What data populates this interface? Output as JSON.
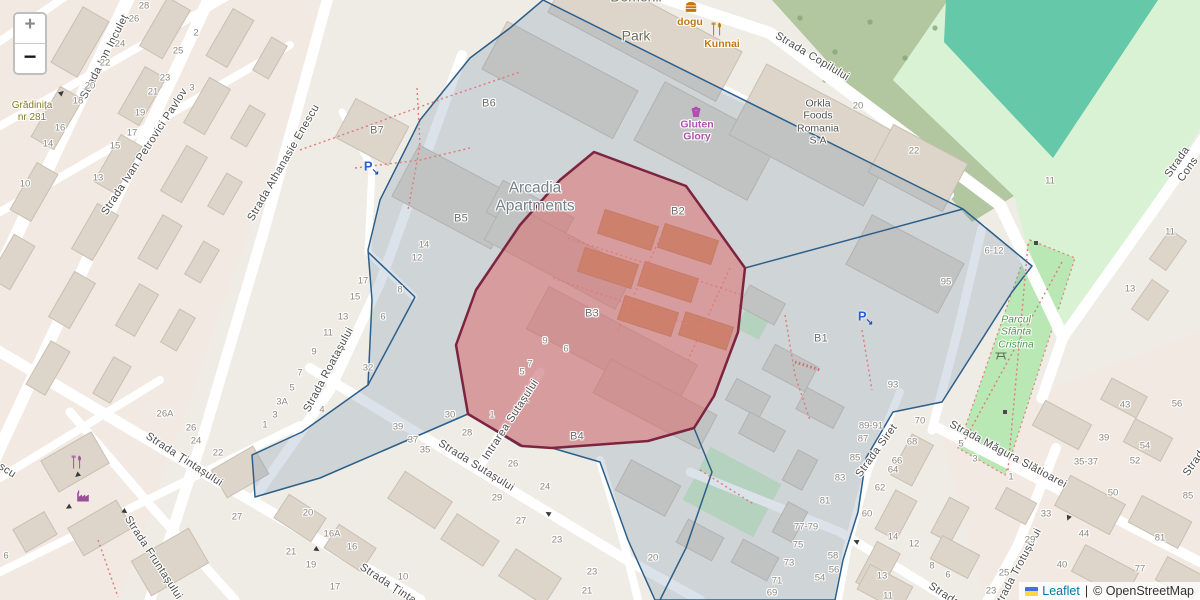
{
  "controls": {
    "zoom_in_label": "+",
    "zoom_out_label": "−"
  },
  "attribution": {
    "flag_icon": "ukraine-flag-icon",
    "leaflet_link": "Leaflet",
    "separator": "|",
    "osm_text": "© OpenStreetMap"
  },
  "colors": {
    "selection_red_fill": "#e05c5c",
    "selection_red_stroke": "#7d2440",
    "boundary_blue_stroke": "#2c5f8a",
    "boundary_blue_fill": "rgba(110,140,170,0.25)",
    "park_green": "#b9e8b4",
    "pitch_teal": "#56c3a4",
    "wood_green": "#a7bf93",
    "road_white": "#ffffff"
  },
  "map_labels": [
    {
      "text": "Strada Ion Inculeț",
      "x": 105,
      "y": 57,
      "rot": -63,
      "cls": "street"
    },
    {
      "text": "Strada Ivan Petrovici Pavlov",
      "x": 145,
      "y": 152,
      "rot": -57,
      "cls": "street"
    },
    {
      "text": "Strada Athanasie Enescu",
      "x": 284,
      "y": 163,
      "rot": -60,
      "cls": "street"
    },
    {
      "text": "Strada Copilului",
      "x": 812,
      "y": 57,
      "rot": 31,
      "cls": "street"
    },
    {
      "text": "Strada Cons",
      "x": 1183,
      "y": 166,
      "rot": -55,
      "cls": "street"
    },
    {
      "text": "Strada Roatașului",
      "x": 329,
      "y": 370,
      "rot": -62,
      "cls": "street"
    },
    {
      "text": "Strada Țintașului",
      "x": 184,
      "y": 460,
      "rot": 33,
      "cls": "street"
    },
    {
      "text": "Strada Țintașului",
      "x": 398,
      "y": 591,
      "rot": 33,
      "cls": "street"
    },
    {
      "text": "Strada Fruntașului",
      "x": 153,
      "y": 558,
      "rot": 57,
      "cls": "street"
    },
    {
      "text": "Strada Sutașului",
      "x": 476,
      "y": 466,
      "rot": 32,
      "cls": "street"
    },
    {
      "text": "Intrarea Sutașului",
      "x": 511,
      "y": 420,
      "rot": -57,
      "cls": "street"
    },
    {
      "text": "Strada Siret",
      "x": 877,
      "y": 451,
      "rot": -54,
      "cls": "street"
    },
    {
      "text": "Strada Măgura Slătioarei",
      "x": 1008,
      "y": 455,
      "rot": 28,
      "cls": "street"
    },
    {
      "text": "Strada Trotușului",
      "x": 1018,
      "y": 569,
      "rot": -62,
      "cls": "street"
    },
    {
      "text": "Strada",
      "x": 1196,
      "y": 461,
      "rot": -55,
      "cls": "street"
    },
    {
      "text": "Strada",
      "x": 944,
      "y": 595,
      "rot": 33,
      "cls": "street"
    },
    {
      "text": "scu",
      "x": 7,
      "y": 471,
      "rot": 33,
      "cls": "street"
    },
    {
      "text": "Domenii",
      "x": 636,
      "y": -3,
      "rot": 0,
      "cls": "poi-park-name"
    },
    {
      "text": "Park",
      "x": 636,
      "y": 36,
      "rot": 0,
      "cls": "poi-park-name"
    },
    {
      "text": "dogu",
      "x": 690,
      "y": 22,
      "rot": 0,
      "cls": "poi-food"
    },
    {
      "text": "Kunnai",
      "x": 722,
      "y": 44,
      "rot": 0,
      "cls": "poi-food"
    },
    {
      "text": "Gluten\nGlory",
      "x": 697,
      "y": 131,
      "rot": 0,
      "cls": "poi-shop"
    },
    {
      "text": "Orkla\nFoods\nRomania\nS.A",
      "x": 818,
      "y": 122,
      "rot": 0,
      "cls": "poi-building"
    },
    {
      "text": "Arcadia\nApartments",
      "x": 535,
      "y": 198,
      "rot": 0,
      "cls": "poi-complex"
    },
    {
      "text": "Parcul\nSfânta\nCristina",
      "x": 1016,
      "y": 332,
      "rot": 0,
      "cls": "poi-park-green"
    },
    {
      "text": "Grădinița\nnr 281",
      "x": 32,
      "y": 112,
      "rot": 0,
      "cls": "poi-school"
    },
    {
      "text": "B7",
      "x": 377,
      "y": 131,
      "rot": 0,
      "cls": "block"
    },
    {
      "text": "B6",
      "x": 489,
      "y": 104,
      "rot": 0,
      "cls": "block"
    },
    {
      "text": "B5",
      "x": 461,
      "y": 219,
      "rot": 0,
      "cls": "block"
    },
    {
      "text": "B2",
      "x": 678,
      "y": 212,
      "rot": 0,
      "cls": "block"
    },
    {
      "text": "B3",
      "x": 592,
      "y": 314,
      "rot": 0,
      "cls": "block"
    },
    {
      "text": "B1",
      "x": 821,
      "y": 339,
      "rot": 0,
      "cls": "block"
    },
    {
      "text": "B4",
      "x": 577,
      "y": 437,
      "rot": 0,
      "cls": "block"
    },
    {
      "text": "28",
      "x": 144,
      "y": 6,
      "rot": 0,
      "cls": "hnum"
    },
    {
      "text": "26",
      "x": 134,
      "y": 19,
      "rot": 0,
      "cls": "hnum"
    },
    {
      "text": "24",
      "x": 120,
      "y": 44,
      "rot": 0,
      "cls": "hnum"
    },
    {
      "text": "22",
      "x": 105,
      "y": 63,
      "rot": 0,
      "cls": "hnum"
    },
    {
      "text": "20",
      "x": 90,
      "y": 86,
      "rot": 0,
      "cls": "hnum"
    },
    {
      "text": "18",
      "x": 78,
      "y": 101,
      "rot": 0,
      "cls": "hnum"
    },
    {
      "text": "16",
      "x": 60,
      "y": 128,
      "rot": 0,
      "cls": "hnum"
    },
    {
      "text": "14",
      "x": 48,
      "y": 144,
      "rot": 0,
      "cls": "hnum"
    },
    {
      "text": "13",
      "x": 98,
      "y": 178,
      "rot": 0,
      "cls": "hnum"
    },
    {
      "text": "10",
      "x": 25,
      "y": 184,
      "rot": 0,
      "cls": "hnum"
    },
    {
      "text": "25",
      "x": 178,
      "y": 51,
      "rot": 0,
      "cls": "hnum"
    },
    {
      "text": "23",
      "x": 165,
      "y": 78,
      "rot": 0,
      "cls": "hnum"
    },
    {
      "text": "21",
      "x": 153,
      "y": 92,
      "rot": 0,
      "cls": "hnum"
    },
    {
      "text": "19",
      "x": 140,
      "y": 113,
      "rot": 0,
      "cls": "hnum"
    },
    {
      "text": "17",
      "x": 132,
      "y": 133,
      "rot": 0,
      "cls": "hnum"
    },
    {
      "text": "15",
      "x": 115,
      "y": 146,
      "rot": 0,
      "cls": "hnum"
    },
    {
      "text": "2",
      "x": 196,
      "y": 33,
      "rot": 0,
      "cls": "hnum"
    },
    {
      "text": "3",
      "x": 192,
      "y": 88,
      "rot": 0,
      "cls": "hnum"
    },
    {
      "text": "20",
      "x": 858,
      "y": 106,
      "rot": 0,
      "cls": "hnum"
    },
    {
      "text": "22",
      "x": 914,
      "y": 151,
      "rot": 0,
      "cls": "hnum"
    },
    {
      "text": "11",
      "x": 1050,
      "y": 181,
      "rot": 0,
      "cls": "hnum"
    },
    {
      "text": "11",
      "x": 1170,
      "y": 232,
      "rot": 0,
      "cls": "hnum"
    },
    {
      "text": "13",
      "x": 1130,
      "y": 289,
      "rot": 0,
      "cls": "hnum"
    },
    {
      "text": "6-12",
      "x": 994,
      "y": 251,
      "rot": 0,
      "cls": "hnum"
    },
    {
      "text": "95",
      "x": 946,
      "y": 282,
      "rot": 0,
      "cls": "hnum"
    },
    {
      "text": "93",
      "x": 893,
      "y": 385,
      "rot": 0,
      "cls": "hnum"
    },
    {
      "text": "70",
      "x": 920,
      "y": 421,
      "rot": 0,
      "cls": "hnum"
    },
    {
      "text": "68",
      "x": 912,
      "y": 442,
      "rot": 0,
      "cls": "hnum"
    },
    {
      "text": "66",
      "x": 897,
      "y": 461,
      "rot": 0,
      "cls": "hnum"
    },
    {
      "text": "64",
      "x": 893,
      "y": 470,
      "rot": 0,
      "cls": "hnum"
    },
    {
      "text": "62",
      "x": 880,
      "y": 488,
      "rot": 0,
      "cls": "hnum"
    },
    {
      "text": "60",
      "x": 867,
      "y": 514,
      "rot": 0,
      "cls": "hnum"
    },
    {
      "text": "58",
      "x": 833,
      "y": 556,
      "rot": 0,
      "cls": "hnum"
    },
    {
      "text": "56",
      "x": 834,
      "y": 570,
      "rot": 0,
      "cls": "hnum"
    },
    {
      "text": "54",
      "x": 820,
      "y": 578,
      "rot": 0,
      "cls": "hnum"
    },
    {
      "text": "89-91",
      "x": 871,
      "y": 426,
      "rot": 0,
      "cls": "hnum"
    },
    {
      "text": "87",
      "x": 863,
      "y": 439,
      "rot": 0,
      "cls": "hnum"
    },
    {
      "text": "85",
      "x": 855,
      "y": 458,
      "rot": 0,
      "cls": "hnum"
    },
    {
      "text": "83",
      "x": 840,
      "y": 478,
      "rot": 0,
      "cls": "hnum"
    },
    {
      "text": "81",
      "x": 825,
      "y": 501,
      "rot": 0,
      "cls": "hnum"
    },
    {
      "text": "77-79",
      "x": 806,
      "y": 527,
      "rot": 0,
      "cls": "hnum"
    },
    {
      "text": "75",
      "x": 798,
      "y": 545,
      "rot": 0,
      "cls": "hnum"
    },
    {
      "text": "73",
      "x": 789,
      "y": 563,
      "rot": 0,
      "cls": "hnum"
    },
    {
      "text": "71",
      "x": 777,
      "y": 581,
      "rot": 0,
      "cls": "hnum"
    },
    {
      "text": "69",
      "x": 772,
      "y": 593,
      "rot": 0,
      "cls": "hnum"
    },
    {
      "text": "14",
      "x": 893,
      "y": 537,
      "rot": 0,
      "cls": "hnum"
    },
    {
      "text": "12",
      "x": 914,
      "y": 544,
      "rot": 0,
      "cls": "hnum"
    },
    {
      "text": "8",
      "x": 932,
      "y": 566,
      "rot": 0,
      "cls": "hnum"
    },
    {
      "text": "6",
      "x": 948,
      "y": 575,
      "rot": 0,
      "cls": "hnum"
    },
    {
      "text": "13",
      "x": 882,
      "y": 576,
      "rot": 0,
      "cls": "hnum"
    },
    {
      "text": "11",
      "x": 888,
      "y": 596,
      "rot": 0,
      "cls": "hnum"
    },
    {
      "text": "5",
      "x": 961,
      "y": 444,
      "rot": 0,
      "cls": "hnum"
    },
    {
      "text": "3",
      "x": 975,
      "y": 459,
      "rot": 0,
      "cls": "hnum"
    },
    {
      "text": "43",
      "x": 1125,
      "y": 405,
      "rot": 0,
      "cls": "hnum"
    },
    {
      "text": "39",
      "x": 1104,
      "y": 438,
      "rot": 0,
      "cls": "hnum"
    },
    {
      "text": "35-37",
      "x": 1086,
      "y": 462,
      "rot": 0,
      "cls": "hnum"
    },
    {
      "text": "56",
      "x": 1177,
      "y": 404,
      "rot": 0,
      "cls": "hnum"
    },
    {
      "text": "54",
      "x": 1145,
      "y": 446,
      "rot": 0,
      "cls": "hnum"
    },
    {
      "text": "52",
      "x": 1135,
      "y": 461,
      "rot": 0,
      "cls": "hnum"
    },
    {
      "text": "50",
      "x": 1113,
      "y": 493,
      "rot": 0,
      "cls": "hnum"
    },
    {
      "text": "44",
      "x": 1084,
      "y": 534,
      "rot": 0,
      "cls": "hnum"
    },
    {
      "text": "40",
      "x": 1062,
      "y": 565,
      "rot": 0,
      "cls": "hnum"
    },
    {
      "text": "33",
      "x": 1046,
      "y": 514,
      "rot": 0,
      "cls": "hnum"
    },
    {
      "text": "29",
      "x": 1030,
      "y": 540,
      "rot": 0,
      "cls": "hnum"
    },
    {
      "text": "25",
      "x": 1004,
      "y": 573,
      "rot": 0,
      "cls": "hnum"
    },
    {
      "text": "23",
      "x": 991,
      "y": 591,
      "rot": 0,
      "cls": "hnum"
    },
    {
      "text": "1",
      "x": 1011,
      "y": 477,
      "rot": 0,
      "cls": "hnum"
    },
    {
      "text": "85",
      "x": 1188,
      "y": 496,
      "rot": 0,
      "cls": "hnum"
    },
    {
      "text": "81",
      "x": 1160,
      "y": 538,
      "rot": 0,
      "cls": "hnum"
    },
    {
      "text": "77",
      "x": 1140,
      "y": 569,
      "rot": 0,
      "cls": "hnum"
    },
    {
      "text": "17",
      "x": 363,
      "y": 281,
      "rot": 0,
      "cls": "hnum"
    },
    {
      "text": "15",
      "x": 355,
      "y": 297,
      "rot": 0,
      "cls": "hnum"
    },
    {
      "text": "13",
      "x": 343,
      "y": 317,
      "rot": 0,
      "cls": "hnum"
    },
    {
      "text": "11",
      "x": 328,
      "y": 333,
      "rot": 0,
      "cls": "hnum"
    },
    {
      "text": "9",
      "x": 314,
      "y": 352,
      "rot": 0,
      "cls": "hnum"
    },
    {
      "text": "7",
      "x": 300,
      "y": 373,
      "rot": 0,
      "cls": "hnum"
    },
    {
      "text": "5",
      "x": 292,
      "y": 388,
      "rot": 0,
      "cls": "hnum"
    },
    {
      "text": "3A",
      "x": 282,
      "y": 402,
      "rot": 0,
      "cls": "hnum"
    },
    {
      "text": "3",
      "x": 275,
      "y": 415,
      "rot": 0,
      "cls": "hnum"
    },
    {
      "text": "1",
      "x": 265,
      "y": 425,
      "rot": 0,
      "cls": "hnum"
    },
    {
      "text": "8",
      "x": 400,
      "y": 290,
      "rot": 0,
      "cls": "hnum"
    },
    {
      "text": "6",
      "x": 383,
      "y": 317,
      "rot": 0,
      "cls": "hnum"
    },
    {
      "text": "32",
      "x": 368,
      "y": 368,
      "rot": 0,
      "cls": "hnum"
    },
    {
      "text": "4",
      "x": 322,
      "y": 410,
      "rot": 0,
      "cls": "hnum"
    },
    {
      "text": "30",
      "x": 450,
      "y": 415,
      "rot": 0,
      "cls": "hnum"
    },
    {
      "text": "28",
      "x": 467,
      "y": 433,
      "rot": 0,
      "cls": "hnum"
    },
    {
      "text": "39",
      "x": 398,
      "y": 427,
      "rot": 0,
      "cls": "hnum"
    },
    {
      "text": "37",
      "x": 413,
      "y": 440,
      "rot": 0,
      "cls": "hnum"
    },
    {
      "text": "35",
      "x": 425,
      "y": 450,
      "rot": 0,
      "cls": "hnum"
    },
    {
      "text": "14",
      "x": 424,
      "y": 245,
      "rot": 0,
      "cls": "hnum"
    },
    {
      "text": "12",
      "x": 417,
      "y": 258,
      "rot": 0,
      "cls": "hnum"
    },
    {
      "text": "26A",
      "x": 165,
      "y": 414,
      "rot": 0,
      "cls": "hnum"
    },
    {
      "text": "26",
      "x": 191,
      "y": 428,
      "rot": 0,
      "cls": "hnum"
    },
    {
      "text": "24",
      "x": 196,
      "y": 441,
      "rot": 0,
      "cls": "hnum"
    },
    {
      "text": "22",
      "x": 218,
      "y": 453,
      "rot": 0,
      "cls": "hnum"
    },
    {
      "text": "27",
      "x": 237,
      "y": 517,
      "rot": 0,
      "cls": "hnum"
    },
    {
      "text": "6",
      "x": 6,
      "y": 556,
      "rot": 0,
      "cls": "hnum"
    },
    {
      "text": "20",
      "x": 308,
      "y": 513,
      "rot": 0,
      "cls": "hnum"
    },
    {
      "text": "16A",
      "x": 332,
      "y": 534,
      "rot": 0,
      "cls": "hnum"
    },
    {
      "text": "16",
      "x": 352,
      "y": 547,
      "rot": 0,
      "cls": "hnum"
    },
    {
      "text": "21",
      "x": 291,
      "y": 552,
      "rot": 0,
      "cls": "hnum"
    },
    {
      "text": "19",
      "x": 311,
      "y": 565,
      "rot": 0,
      "cls": "hnum"
    },
    {
      "text": "17",
      "x": 335,
      "y": 587,
      "rot": 0,
      "cls": "hnum"
    },
    {
      "text": "10",
      "x": 403,
      "y": 577,
      "rot": 0,
      "cls": "hnum"
    },
    {
      "text": "26",
      "x": 513,
      "y": 464,
      "rot": 0,
      "cls": "hnum"
    },
    {
      "text": "24",
      "x": 545,
      "y": 487,
      "rot": 0,
      "cls": "hnum"
    },
    {
      "text": "29",
      "x": 497,
      "y": 498,
      "rot": 0,
      "cls": "hnum"
    },
    {
      "text": "27",
      "x": 521,
      "y": 521,
      "rot": 0,
      "cls": "hnum"
    },
    {
      "text": "23",
      "x": 557,
      "y": 540,
      "rot": 0,
      "cls": "hnum"
    },
    {
      "text": "23",
      "x": 592,
      "y": 572,
      "rot": 0,
      "cls": "hnum"
    },
    {
      "text": "21",
      "x": 587,
      "y": 591,
      "rot": 0,
      "cls": "hnum"
    },
    {
      "text": "20",
      "x": 653,
      "y": 558,
      "rot": 0,
      "cls": "hnum"
    },
    {
      "text": "9",
      "x": 545,
      "y": 341,
      "rot": 0,
      "cls": "hnum"
    },
    {
      "text": "6",
      "x": 566,
      "y": 349,
      "rot": 0,
      "cls": "hnum"
    },
    {
      "text": "7",
      "x": 530,
      "y": 364,
      "rot": 0,
      "cls": "hnum"
    },
    {
      "text": "5",
      "x": 522,
      "y": 372,
      "rot": 0,
      "cls": "hnum"
    },
    {
      "text": "1",
      "x": 492,
      "y": 415,
      "rot": 0,
      "cls": "hnum"
    }
  ],
  "map_icons": [
    {
      "name": "parking-icon",
      "x": 372,
      "y": 166
    },
    {
      "name": "parking-icon",
      "x": 866,
      "y": 316
    },
    {
      "name": "fast-food-icon",
      "x": 691,
      "y": 7
    },
    {
      "name": "restaurant-icon",
      "x": 717,
      "y": 29,
      "color": "#c77400"
    },
    {
      "name": "confectionery-icon",
      "x": 696,
      "y": 112
    },
    {
      "name": "restaurant-icon",
      "x": 77,
      "y": 462,
      "color": "#ab4bab"
    },
    {
      "name": "works-icon",
      "x": 83,
      "y": 496
    },
    {
      "name": "picnic-site-icon",
      "x": 1001,
      "y": 355
    },
    {
      "name": "oneway-arrow-icon",
      "x": 62,
      "y": 93,
      "rot": -40
    },
    {
      "name": "oneway-arrow-icon",
      "x": 77,
      "y": 475,
      "rot": 140
    },
    {
      "name": "oneway-arrow-icon",
      "x": 68,
      "y": 507,
      "rot": 150
    },
    {
      "name": "oneway-arrow-icon",
      "x": 125,
      "y": 512,
      "rot": 35
    },
    {
      "name": "oneway-arrow-icon",
      "x": 317,
      "y": 550,
      "rot": 33
    },
    {
      "name": "oneway-arrow-icon",
      "x": 548,
      "y": 513,
      "rot": 212
    },
    {
      "name": "oneway-arrow-icon",
      "x": 856,
      "y": 541,
      "rot": 205
    },
    {
      "name": "oneway-arrow-icon",
      "x": 1068,
      "y": 518,
      "rot": 112
    }
  ]
}
